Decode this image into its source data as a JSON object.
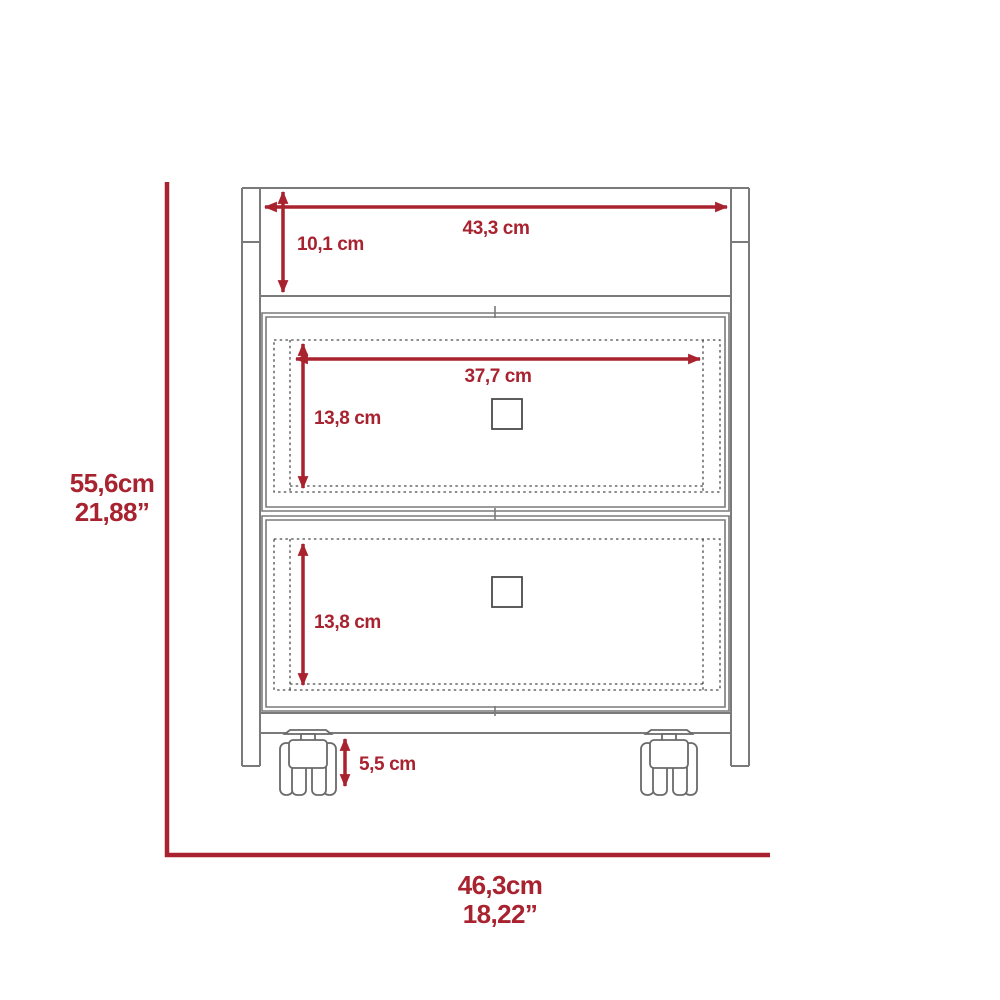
{
  "diagram_title": "two-drawer-cabinet-dimension-drawing",
  "colors": {
    "accent": "#A8222F",
    "line": "#7a7a7a",
    "detail": "#4a4a4a",
    "caster": "#6a6a6a",
    "background": "#ffffff"
  },
  "annotations": {
    "top_width": "43,3 cm",
    "top_height": "10,1 cm",
    "drawer_width": "37,7 cm",
    "drawer1_height": "13,8 cm",
    "drawer2_height": "13,8 cm",
    "caster_height": "5,5 cm",
    "overall_height_cm": "55,6cm",
    "overall_height_in": "21,88”",
    "overall_width_cm": "46,3cm",
    "overall_width_in": "18,22”"
  }
}
